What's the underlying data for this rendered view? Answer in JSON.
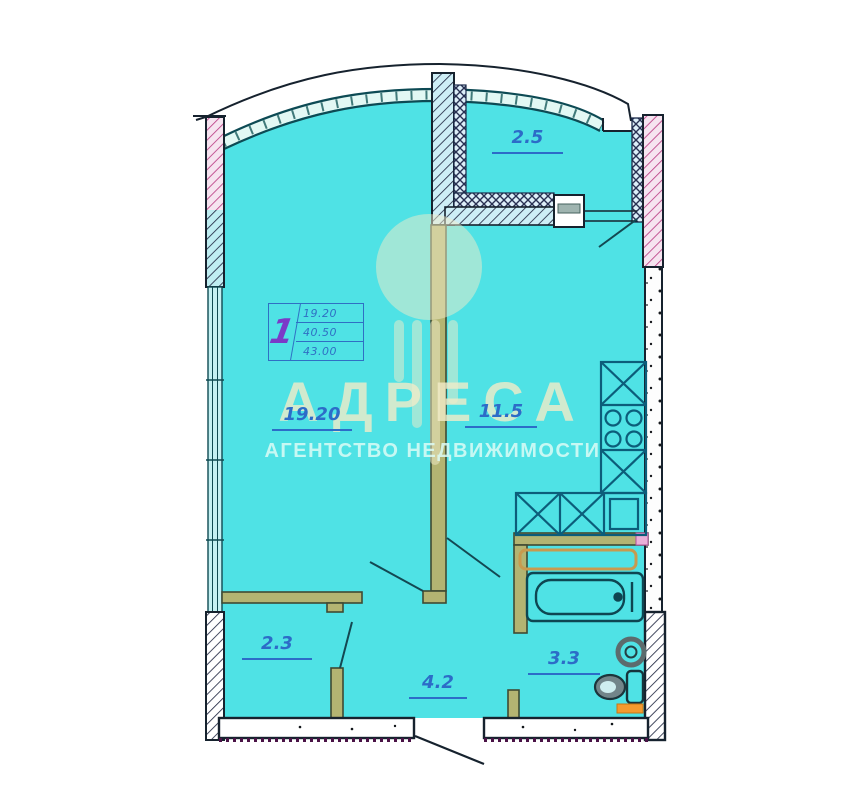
{
  "plan": {
    "type": "apartment-floor-plan",
    "info_box": {
      "rooms_count": "1",
      "values": [
        "19.20",
        "40.50",
        "43.00"
      ]
    },
    "rooms": [
      {
        "name": "balcony",
        "area_label": "2.5"
      },
      {
        "name": "living-room",
        "area_label": "19.20"
      },
      {
        "name": "kitchen",
        "area_label": "11.5"
      },
      {
        "name": "storage",
        "area_label": "2.3"
      },
      {
        "name": "hallway",
        "area_label": "4.2"
      },
      {
        "name": "bathroom",
        "area_label": "3.3"
      }
    ]
  },
  "watermark": {
    "brand": "АДРЕСА",
    "subtitle": "АГЕНТСТВО НЕДВИЖИМОСТИ"
  },
  "colors": {
    "floor": "#4fe2e5",
    "wall-line": "#16222e",
    "label": "#2c6cc8",
    "table-blue": "#2f6fc4",
    "accent-purple": "#7b3ac8",
    "partition-olive": "#b3b472",
    "hatch-pink": "#bb3f85",
    "watermark-yellow": "#f2ecc9",
    "watermark-sub": "#ddfcf6",
    "orange": "#f49a2e"
  }
}
